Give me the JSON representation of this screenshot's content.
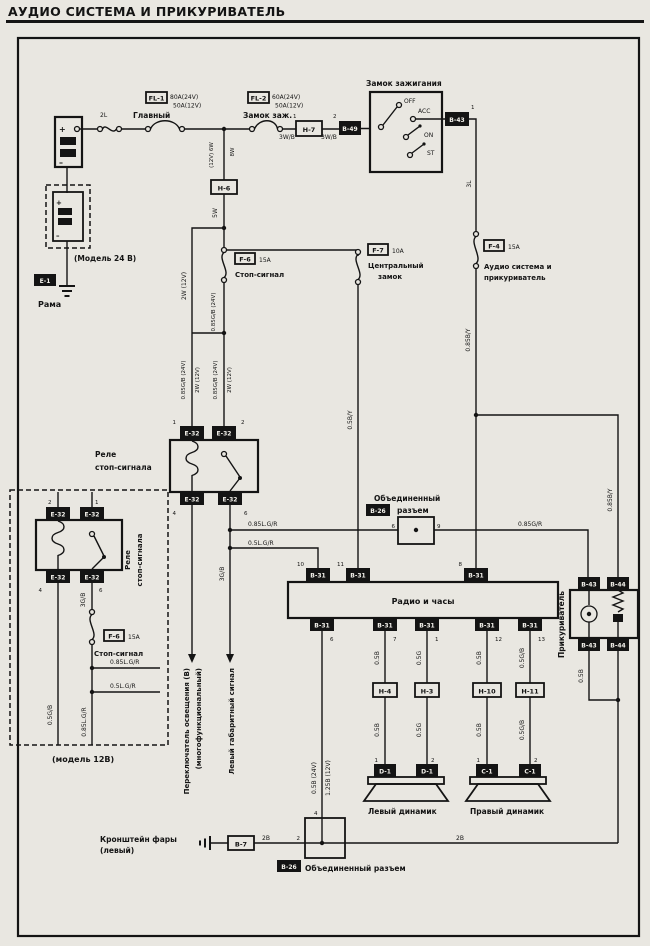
{
  "title": "АУДИО СИСТЕМА И ПРИКУРИВАТЕЛЬ",
  "battery": {
    "model24": "(Модель 24 В)",
    "model12": "(модель 12В)",
    "frame": "Рама",
    "tag": "E-1",
    "plus": "+",
    "minus": "–"
  },
  "power": {
    "w2l": "2L",
    "main_name": "Главный",
    "fl1": "FL-1",
    "fl1_r1": "80A(24V)",
    "fl1_r2": "50A(12V)",
    "fl2": "FL-2",
    "fl2_r1": "60A(24V)",
    "fl2_r2": "50A(12V)",
    "ign_name": "Замок заж.",
    "w3wb": "3W/B",
    "h7": "H-7",
    "b49": "B-49",
    "w12v6w": "(12V) 6W",
    "w8w": "8W",
    "h6": "H-6",
    "w5w": "5W",
    "pin1": "1",
    "pin2": "2"
  },
  "ignition": {
    "name": "Замок зажигания",
    "off": "OFF",
    "acc": "ACC",
    "on": "ON",
    "st": "ST",
    "b43": "B-43",
    "pin1": "1",
    "w3l": "3L"
  },
  "f4": {
    "tag": "F-4",
    "amp": "15A",
    "name1": "Аудио система и",
    "name2": "прикуриватель",
    "wire": "0.85B/Y"
  },
  "f6": {
    "tag": "F-6",
    "amp": "15A",
    "name": "Стоп-сигнал",
    "wleft": "2W (12V)",
    "wright": "0.85G/B (24V)",
    "pair_a": "0.85G/B (24V)",
    "pair_b": "2W (12V)"
  },
  "f7": {
    "tag": "F-7",
    "amp": "10A",
    "name1": "Центральный",
    "name2": "замок",
    "wire": "0.5B/Y"
  },
  "relay": {
    "name1": "Реле",
    "name2": "стоп-сигнала",
    "tag": "E-32",
    "pin1": "1",
    "pin2": "2",
    "pin4": "4",
    "pin6": "6",
    "out": "3G/B",
    "dest1a": "Переключатель освещения (В)",
    "dest1b": "(многофункциональный)",
    "dest2": "Левый габаритный сигнал"
  },
  "relay12": {
    "wleft": "0.5G/B",
    "w3gb": "3G/B",
    "wmid": "0.85L.G/R",
    "br1": "0.85L.G/R",
    "br2": "0.5L.G/R"
  },
  "branches": {
    "b1": "0.85L.G/R",
    "b2": "0.5L.G/R",
    "b3": "0.85G/R"
  },
  "joint": {
    "name1": "Объединенный",
    "name2": "разъем",
    "name_full": "Объединенный разъем",
    "tag": "B-26",
    "pin6": "6",
    "pin9": "9",
    "pin4": "4",
    "pin2": "2"
  },
  "radio": {
    "name": "Радио и часы",
    "tag": "B-31",
    "pins_top": [
      "10",
      "11",
      "8"
    ],
    "pins_bottom": [
      "6",
      "7",
      "1",
      "12",
      "13"
    ],
    "w1": "0.5B (24V)",
    "w2": "1.25B (12V)",
    "s1": "0.5B",
    "s2": "0.5G",
    "s3": "0.5B",
    "s4": "0.5G/B"
  },
  "hconn": {
    "h4": "H-4",
    "h3": "H-3",
    "h10": "H-10",
    "h11": "H-11"
  },
  "speakers": {
    "left": "Левый динамик",
    "right": "Правый динамик",
    "tagL": "D-1",
    "tagR": "C-1",
    "pin1": "1",
    "pin2": "2"
  },
  "lighter": {
    "name": "Прикуриватель",
    "b43": "B-43",
    "b44": "B-44",
    "w05b": "0.5B",
    "wire": "0.85B/Y"
  },
  "ground": {
    "bracket1": "Кронштейн фары",
    "bracket2": "(левый)",
    "b7": "B-7",
    "w2b": "2B"
  }
}
